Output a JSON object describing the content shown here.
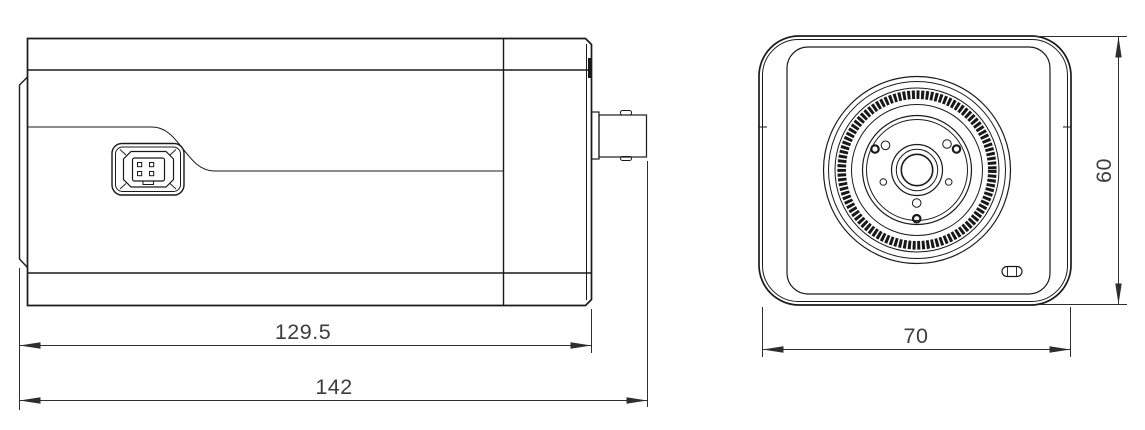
{
  "colors": {
    "background": "#ffffff",
    "line": "#1a1a1a",
    "dimension_text": "#3d3d3d",
    "dimension_line": "#2e2e2e"
  },
  "side_view": {
    "dim_body_length": "129.5",
    "dim_overall_length": "142"
  },
  "front_view": {
    "dim_width": "70",
    "dim_height": "60"
  }
}
